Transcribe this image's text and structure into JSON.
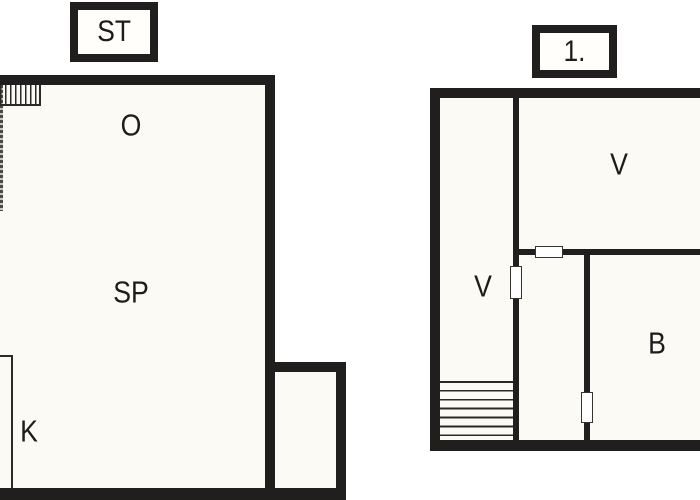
{
  "document": {
    "type": "floor-plan-drawing",
    "colors": {
      "wall": "#201f1d",
      "interior_fill": "#fbfaf4",
      "background": "#ffffff",
      "door_opening": "#ffffff",
      "text": "#1c1c1c"
    }
  },
  "ground_floor": {
    "badge": "ST",
    "rooms": [
      {
        "id": "o",
        "label": "O"
      },
      {
        "id": "sp",
        "label": "SP"
      },
      {
        "id": "k",
        "label": "K"
      }
    ]
  },
  "first_floor": {
    "badge": "1.",
    "rooms": [
      {
        "id": "v-upper",
        "label": "V"
      },
      {
        "id": "v-corridor",
        "label": "V"
      },
      {
        "id": "b",
        "label": "B"
      }
    ]
  }
}
